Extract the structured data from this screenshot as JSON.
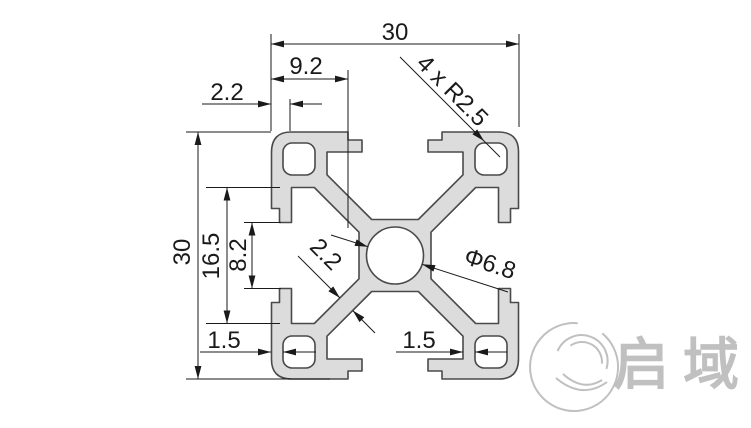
{
  "drawing": {
    "dimensions": {
      "overall_width": "30",
      "top_slot_offset": "9.2",
      "top_wall": "2.2",
      "corner_radii": "4 x R2.5",
      "overall_height": "30",
      "channel_inner_width": "16.5",
      "slot_opening": "8.2",
      "web_thickness": "2.2",
      "center_bore": "Φ6.8",
      "bottom_left_wall": "1.5",
      "bottom_right_wall": "1.5"
    },
    "colors": {
      "profile_fill": "#dcdcdc",
      "profile_stroke": "#4a4a4a",
      "dimension_color": "#1a1a1a",
      "logo_color": "#c0c0c0"
    }
  },
  "logo": {
    "wordmark": "启域"
  }
}
